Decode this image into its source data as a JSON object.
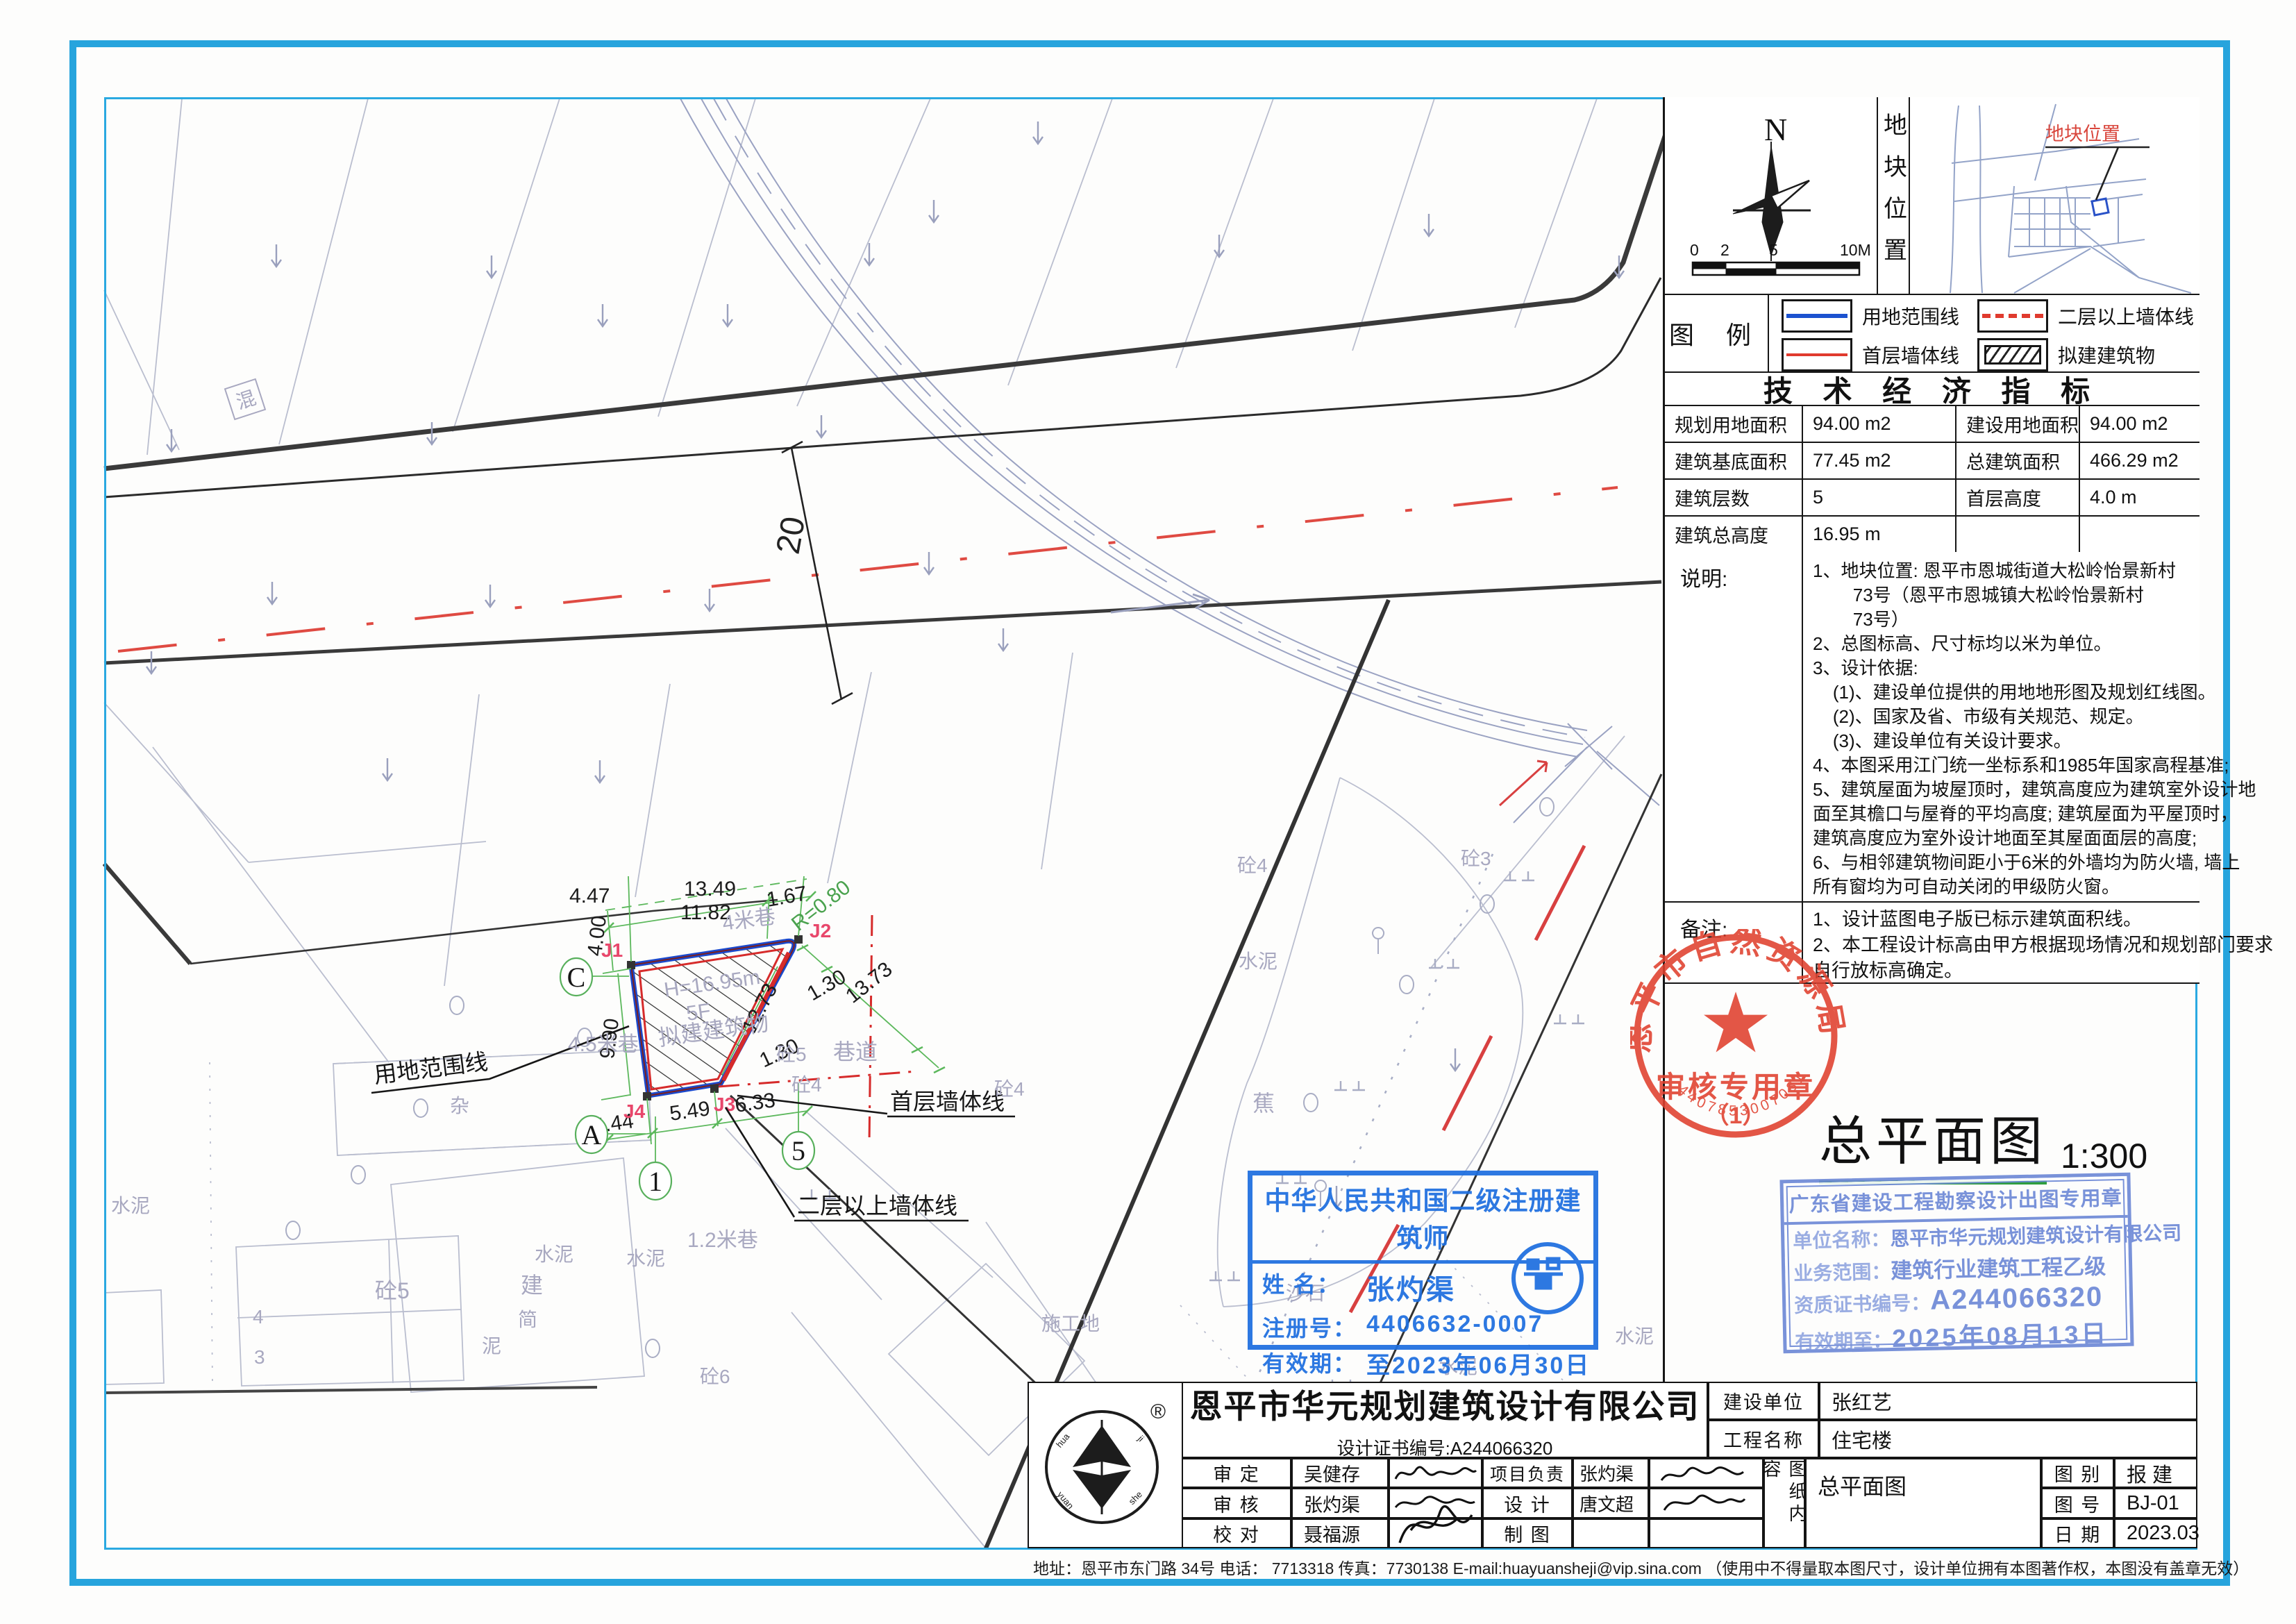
{
  "frame": {
    "footer": "地址：恩平市东门路 34号  电话： 7713318  传真：7730138  E-mail:huayuansheji@vip.sina.com （使用中不得量取本图尺寸，设计单位拥有本图著作权，本图没有盖章无效）"
  },
  "panel": {
    "north": "N",
    "scale_ticks": [
      "0",
      "2",
      "5",
      "10M"
    ],
    "loc_title": "地块位置",
    "map_label": "地块位置",
    "legend_title": "图 例",
    "legend": [
      {
        "label": "用地范围线"
      },
      {
        "label": "二层以上墙体线"
      },
      {
        "label": "首层墙体线"
      },
      {
        "label": "拟建建筑物"
      }
    ],
    "tech_title": "技 术 经 济 指 标",
    "tech_rows": [
      {
        "l1": "规划用地面积",
        "v1": "94.00 m2",
        "l2": "建设用地面积",
        "v2": "94.00 m2"
      },
      {
        "l1": "建筑基底面积",
        "v1": "77.45 m2",
        "l2": "总建筑面积",
        "v2": "466.29 m2"
      },
      {
        "l1": "建筑层数",
        "v1": "5",
        "l2": "首层高度",
        "v2": "4.0 m"
      },
      {
        "l1": "建筑总高度",
        "v1": "16.95 m",
        "l2": "",
        "v2": ""
      }
    ],
    "notes_label": "说明:",
    "notes": [
      "1、地块位置: 恩平市恩城街道大松岭怡景新村",
      "        73号（恩平市恩城镇大松岭怡景新村",
      "        73号）",
      "2、总图标高、尺寸标均以米为单位。",
      "3、设计依据:",
      "    (1)、建设单位提供的用地地形图及规划红线图。",
      "    (2)、国家及省、市级有关规范、规定。",
      "    (3)、建设单位有关设计要求。",
      "4、本图采用江门统一坐标系和1985年国家高程基准;",
      "5、建筑屋面为坡屋顶时，建筑高度应为建筑室外设计地",
      "面至其檐口与屋脊的平均高度; 建筑屋面为平屋顶时，",
      "建筑高度应为室外设计地面至其屋面面层的高度;",
      "6、与相邻建筑物间距小于6米的外墙均为防火墙, 墙上",
      "所有窗均为可自动关闭的甲级防火窗。"
    ],
    "remarks_label": "备注:",
    "remarks": [
      "1、设计蓝图电子版已标示建筑面积线。",
      "2、本工程设计标高由甲方根据现场情况和规划部门要求",
      "自行放标高确定。"
    ],
    "title": "总平面图",
    "title_scale": "1:300"
  },
  "plan": {
    "dims": {
      "d447": "4.47",
      "d400": "4.00",
      "d1349": "13.49",
      "d1182": "11.82",
      "d167": "1.67",
      "r080": "R=0.80",
      "d990": "9.90",
      "d1273": "12.73",
      "d130a": "1.30",
      "d1373": "13.73",
      "d130b": "1.30",
      "d633": "6.33",
      "d549": "5.49",
      "d444": "4.44",
      "road": "20"
    },
    "grid": {
      "c": "C",
      "a": "A",
      "n1": "1",
      "n5": "5"
    },
    "pts": {
      "j1": "J1",
      "j2": "J2",
      "j3": "J3",
      "j4": "J4"
    },
    "bldg": {
      "h": "H=16.95m",
      "f": "5F",
      "t": "拟建建筑物"
    },
    "callouts": {
      "boundary": "用地范围线",
      "wall1": "首层墙体线",
      "wall2": "二层以上墙体线"
    },
    "labels": {
      "lane4": "4米巷",
      "lane45": "4.5米巷",
      "lane12": "1.2米巷",
      "alley": "巷道",
      "t5a": "砼5",
      "t4a": "砼4",
      "t5b": "砼5",
      "t4b": "砼4",
      "t3": "砼3",
      "t4c": "砼4",
      "t6": "砼6",
      "cem1": "水泥",
      "cem2": "水泥",
      "cem3": "水泥",
      "cem4": "水泥",
      "cem5": "水泥",
      "cem6": "水泥",
      "hun": "混",
      "ni": "泥",
      "jian": "简",
      "za": "杂",
      "jianzhu": "建",
      "jiao": "蕉",
      "shashi": "沙石",
      "shigongdi": "施工地",
      "num4": "4",
      "num3": "3"
    }
  },
  "stamps": {
    "seal": {
      "arc": "恩平市自然资源局",
      "line1": "审核专用章",
      "line2": "（1）",
      "serial": "4407853007031"
    },
    "arch": {
      "title": "中华人民共和国二级注册建筑师",
      "l1": "姓  名：",
      "v1": "张灼渠",
      "l2": "注册号：",
      "v2": "4406632-0007",
      "l3": "有效期：",
      "v3": "至2023年06月30日"
    },
    "gd": {
      "title": "广东省建设工程勘察设计出图专用章",
      "l1": "单位名称：",
      "v1": "恩平市华元规划建筑设计有限公司",
      "l2": "业务范围：",
      "v2": "建筑行业建筑工程乙级",
      "l3": "资质证书编号：",
      "v3": "A244066320",
      "l4": "有效期至：",
      "v4": "2025年08月13日"
    }
  },
  "titleblock": {
    "company": "恩平市华元规划建筑设计有限公司",
    "cert": "设计证书编号:A244066320",
    "client_label": "建设单位",
    "client": "张红艺",
    "project_label": "工程名称",
    "project": "住宅楼",
    "rows": [
      {
        "l1": "审 定",
        "n1": "吴健存",
        "l2": "项目负责",
        "n2": "张灼渠"
      },
      {
        "l1": "审 核",
        "n1": "张灼渠",
        "l2": "设 计",
        "n2": "唐文超"
      },
      {
        "l1": "校 对",
        "n1": "聂福源",
        "l2": "制 图",
        "n2": ""
      }
    ],
    "content_label": "图纸内容",
    "content": "总平面图",
    "meta": [
      {
        "l": "图 别",
        "v": "报 建"
      },
      {
        "l": "图 号",
        "v": "BJ-01"
      },
      {
        "l": "日 期",
        "v": "2023.03"
      }
    ]
  }
}
